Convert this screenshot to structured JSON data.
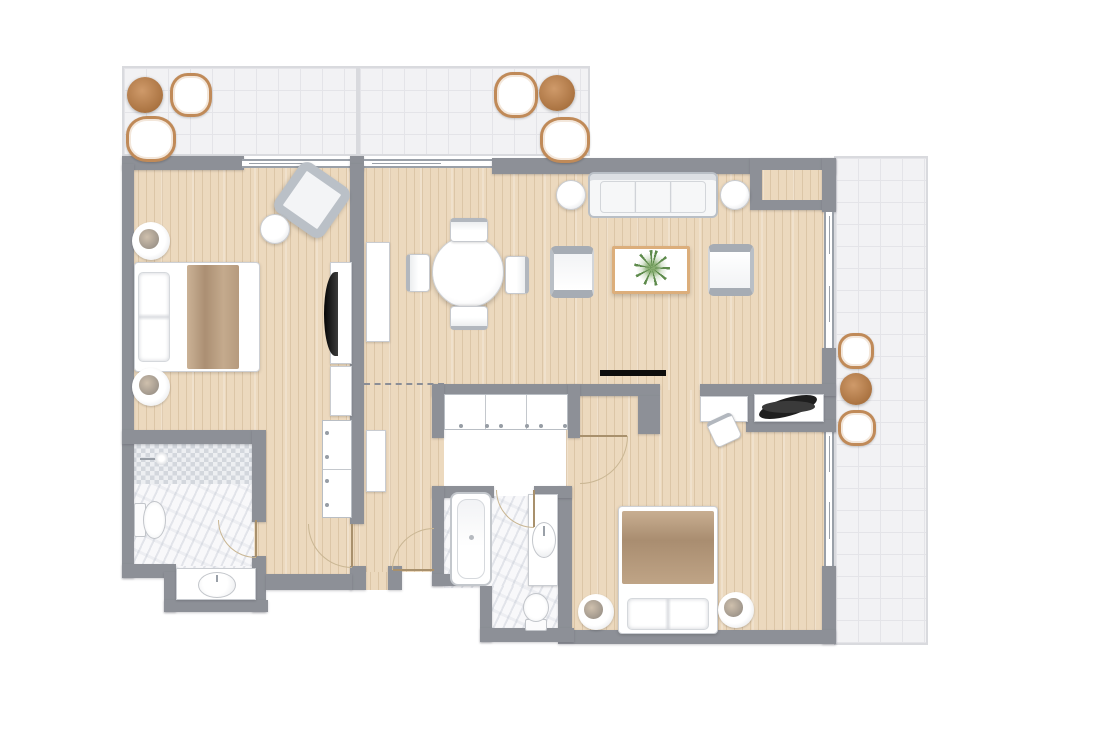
{
  "plan": {
    "kind": "residential-floor-plan",
    "canvas": {
      "width": 1111,
      "height": 739
    },
    "rooms": [
      "balcony-top-left",
      "balcony-top-right",
      "terrace-right",
      "bedroom-1",
      "bathroom-1",
      "hallway",
      "dining-area",
      "living-room",
      "bedroom-2",
      "bathroom-2"
    ]
  },
  "palette": {
    "wall": "#8d9097",
    "wood": "#ecd9be",
    "tile_bg": "#f2f2f4",
    "tile_line": "#e4e4e8",
    "marble": "#f8f8fa",
    "accent_brown": "#b5824f",
    "blanket_tan": "#b69a7e",
    "plant_green": "#5e8b4c",
    "tv_black": "#0c0c0c",
    "door_leaf": "#a8906c",
    "door_arc": "#c9b693"
  },
  "elements": [
    {
      "name": "balcony-top-left",
      "kind": "tile",
      "x": 122,
      "y": 66,
      "w": 236,
      "h": 90
    },
    {
      "name": "balcony-top-right",
      "kind": "tile",
      "x": 358,
      "y": 66,
      "w": 232,
      "h": 90
    },
    {
      "name": "balcony-divider",
      "kind": "balcony-divider",
      "x": 356,
      "y": 66,
      "w": 4,
      "h": 90
    },
    {
      "name": "terrace-right",
      "kind": "tile",
      "x": 834,
      "y": 156,
      "w": 94,
      "h": 489
    },
    {
      "name": "floor-bedroom-1",
      "kind": "wood",
      "x": 130,
      "y": 164,
      "w": 228,
      "h": 410
    },
    {
      "name": "floor-living-dining",
      "kind": "wood",
      "x": 358,
      "y": 168,
      "w": 466,
      "h": 222
    },
    {
      "name": "floor-hallway",
      "kind": "wood",
      "x": 358,
      "y": 390,
      "w": 86,
      "h": 182
    },
    {
      "name": "floor-entry",
      "kind": "wood",
      "x": 362,
      "y": 572,
      "w": 28,
      "h": 18
    },
    {
      "name": "floor-bedroom-2",
      "kind": "wood",
      "x": 566,
      "y": 390,
      "w": 258,
      "h": 244
    },
    {
      "name": "floor-bath-1-main",
      "kind": "marble",
      "x": 130,
      "y": 440,
      "w": 124,
      "h": 128
    },
    {
      "name": "floor-bath-1-alcove",
      "kind": "marble",
      "x": 174,
      "y": 566,
      "w": 82,
      "h": 40
    },
    {
      "name": "shower-mosaic",
      "kind": "mosaic",
      "x": 132,
      "y": 444,
      "w": 122,
      "h": 40
    },
    {
      "name": "floor-bath-2-main",
      "kind": "marble",
      "x": 444,
      "y": 496,
      "w": 114,
      "h": 92
    },
    {
      "name": "floor-bath-2-lower",
      "kind": "marble",
      "x": 492,
      "y": 586,
      "w": 66,
      "h": 44
    },
    {
      "name": "wall-top-bedroom1",
      "kind": "wall",
      "x": 122,
      "y": 156,
      "w": 122,
      "h": 14
    },
    {
      "name": "window-bedroom1-balcony",
      "kind": "window",
      "x": 242,
      "y": 159,
      "w": 110,
      "h": 9
    },
    {
      "name": "wall-top-pillar",
      "kind": "wall",
      "x": 350,
      "y": 156,
      "w": 14,
      "h": 14
    },
    {
      "name": "window-dining-balcony",
      "kind": "window",
      "x": 364,
      "y": 159,
      "w": 128,
      "h": 9
    },
    {
      "name": "wall-top-living",
      "kind": "wall",
      "x": 492,
      "y": 158,
      "w": 344,
      "h": 16
    },
    {
      "name": "wall-niche-topright",
      "kind": "wall",
      "x": 750,
      "y": 158,
      "w": 86,
      "h": 52
    },
    {
      "name": "wood-inset-topright",
      "kind": "wood",
      "x": 762,
      "y": 170,
      "w": 62,
      "h": 30
    },
    {
      "name": "wall-left",
      "kind": "wall",
      "x": 122,
      "y": 164,
      "w": 12,
      "h": 414
    },
    {
      "name": "wall-right-upper",
      "kind": "wall",
      "x": 822,
      "y": 158,
      "w": 14,
      "h": 54
    },
    {
      "name": "window-living-1",
      "kind": "window-v",
      "x": 824,
      "y": 212,
      "w": 10,
      "h": 70
    },
    {
      "name": "window-living-2",
      "kind": "window-v",
      "x": 824,
      "y": 282,
      "w": 10,
      "h": 66
    },
    {
      "name": "wall-right-mid",
      "kind": "wall",
      "x": 822,
      "y": 348,
      "w": 14,
      "h": 84
    },
    {
      "name": "window-bedroom2-1",
      "kind": "window-v",
      "x": 824,
      "y": 432,
      "w": 10,
      "h": 66
    },
    {
      "name": "window-bedroom2-2",
      "kind": "window-v",
      "x": 824,
      "y": 498,
      "w": 10,
      "h": 68
    },
    {
      "name": "wall-right-lower",
      "kind": "wall",
      "x": 822,
      "y": 566,
      "w": 14,
      "h": 78
    },
    {
      "name": "wall-bedroom1-east",
      "kind": "wall",
      "x": 350,
      "y": 164,
      "w": 14,
      "h": 360
    },
    {
      "name": "wall-bedroom1-east-stub",
      "kind": "wall",
      "x": 350,
      "y": 566,
      "w": 16,
      "h": 24
    },
    {
      "name": "wall-bath1-top",
      "kind": "wall",
      "x": 122,
      "y": 430,
      "w": 132,
      "h": 14
    },
    {
      "name": "wall-bath1-east-upper",
      "kind": "wall",
      "x": 252,
      "y": 430,
      "w": 14,
      "h": 92
    },
    {
      "name": "wall-bath1-east-lower",
      "kind": "wall",
      "x": 252,
      "y": 556,
      "w": 14,
      "h": 56
    },
    {
      "name": "wall-bath1-step",
      "kind": "wall",
      "x": 122,
      "y": 564,
      "w": 54,
      "h": 14
    },
    {
      "name": "wall-alcove-west",
      "kind": "wall",
      "x": 164,
      "y": 572,
      "w": 12,
      "h": 40
    },
    {
      "name": "wall-alcove-south",
      "kind": "wall",
      "x": 164,
      "y": 600,
      "w": 104,
      "h": 12
    },
    {
      "name": "wall-hall-south",
      "kind": "wall",
      "x": 266,
      "y": 574,
      "w": 86,
      "h": 16
    },
    {
      "name": "wall-entry-stub",
      "kind": "wall",
      "x": 388,
      "y": 566,
      "w": 14,
      "h": 24
    },
    {
      "name": "wall-closet-north",
      "kind": "wall",
      "x": 432,
      "y": 384,
      "w": 228,
      "h": 12
    },
    {
      "name": "wall-closet-west",
      "kind": "wall",
      "x": 432,
      "y": 384,
      "w": 12,
      "h": 54
    },
    {
      "name": "wall-closet-east",
      "kind": "wall",
      "x": 568,
      "y": 384,
      "w": 12,
      "h": 54
    },
    {
      "name": "wall-bedroom2-entry-east",
      "kind": "wall",
      "x": 638,
      "y": 396,
      "w": 22,
      "h": 38
    },
    {
      "name": "wall-desk-north",
      "kind": "wall",
      "x": 700,
      "y": 384,
      "w": 136,
      "h": 12
    },
    {
      "name": "wall-niche-west",
      "kind": "wall",
      "x": 746,
      "y": 396,
      "w": 10,
      "h": 26
    },
    {
      "name": "wall-niche-south",
      "kind": "wall",
      "x": 746,
      "y": 420,
      "w": 90,
      "h": 12
    },
    {
      "name": "wall-bedroom2-west",
      "kind": "wall",
      "x": 558,
      "y": 486,
      "w": 14,
      "h": 148
    },
    {
      "name": "wall-bedroom2-south",
      "kind": "wall",
      "x": 558,
      "y": 630,
      "w": 278,
      "h": 14
    },
    {
      "name": "wall-bath2-north-a",
      "kind": "wall",
      "x": 432,
      "y": 486,
      "w": 62,
      "h": 12
    },
    {
      "name": "wall-bath2-north-b",
      "kind": "wall",
      "x": 534,
      "y": 486,
      "w": 38,
      "h": 12
    },
    {
      "name": "wall-bath2-west",
      "kind": "wall",
      "x": 432,
      "y": 486,
      "w": 12,
      "h": 100
    },
    {
      "name": "wall-bath2-step",
      "kind": "wall",
      "x": 432,
      "y": 574,
      "w": 52,
      "h": 12
    },
    {
      "name": "wall-bath2-west-lower",
      "kind": "wall",
      "x": 480,
      "y": 586,
      "w": 12,
      "h": 56
    },
    {
      "name": "wall-bath2-south",
      "kind": "wall",
      "x": 480,
      "y": 628,
      "w": 94,
      "h": 14
    },
    {
      "name": "plant-niche-back",
      "kind": "niche-white",
      "x": 754,
      "y": 394,
      "w": 70,
      "h": 28
    },
    {
      "name": "bed-bedroom1",
      "kind": "bed bed-left",
      "x": 134,
      "y": 262,
      "w": 126,
      "h": 110
    },
    {
      "name": "nightstand-lamp-1",
      "kind": "lamp",
      "x": 132,
      "y": 222,
      "w": 38,
      "h": 38
    },
    {
      "name": "nightstand-lamp-2",
      "kind": "lamp",
      "x": 132,
      "y": 368,
      "w": 38,
      "h": 38
    },
    {
      "name": "armchair-bedroom1",
      "kind": "armchair-diag",
      "x": 282,
      "y": 170,
      "w": 60,
      "h": 60,
      "rot": 35
    },
    {
      "name": "side-table-bedroom1",
      "kind": "side-table",
      "x": 260,
      "y": 214,
      "w": 30,
      "h": 30
    },
    {
      "name": "tv-console-bedroom1",
      "kind": "console",
      "x": 330,
      "y": 262,
      "w": 22,
      "h": 102
    },
    {
      "name": "tv-bedroom1",
      "kind": "tv-v",
      "x": 324,
      "y": 272,
      "w": 14,
      "h": 84
    },
    {
      "name": "cabinet-bedroom1",
      "kind": "cabinet",
      "x": 330,
      "y": 366,
      "w": 22,
      "h": 50
    },
    {
      "name": "wardrobe-bedroom1",
      "kind": "wardrobe",
      "x": 322,
      "y": 420,
      "w": 30,
      "h": 98
    },
    {
      "name": "cabinet-hall-tall",
      "kind": "cabinet",
      "x": 366,
      "y": 242,
      "w": 24,
      "h": 100
    },
    {
      "name": "cabinet-hall-small",
      "kind": "cabinet",
      "x": 366,
      "y": 430,
      "w": 20,
      "h": 62
    },
    {
      "name": "closet-sliding-doors",
      "kind": "closet-sliding",
      "x": 444,
      "y": 394,
      "w": 124,
      "h": 36
    },
    {
      "name": "dining-table",
      "kind": "dining-table",
      "x": 432,
      "y": 236,
      "w": 72,
      "h": 72
    },
    {
      "name": "dining-chair-north",
      "kind": "chair",
      "x": 450,
      "y": 218,
      "w": 38,
      "h": 24,
      "rot": 0
    },
    {
      "name": "dining-chair-south",
      "kind": "chair",
      "x": 450,
      "y": 306,
      "w": 38,
      "h": 24,
      "rot": 180
    },
    {
      "name": "dining-chair-west",
      "kind": "chair",
      "x": 399,
      "y": 261,
      "w": 38,
      "h": 24,
      "rot": -90
    },
    {
      "name": "dining-chair-east",
      "kind": "chair",
      "x": 498,
      "y": 263,
      "w": 38,
      "h": 24,
      "rot": 90
    },
    {
      "name": "sofa-living",
      "kind": "sofa",
      "x": 588,
      "y": 172,
      "w": 130,
      "h": 46
    },
    {
      "name": "side-table-sofa-left",
      "kind": "side-table",
      "x": 556,
      "y": 180,
      "w": 30,
      "h": 30
    },
    {
      "name": "side-table-sofa-right",
      "kind": "side-table",
      "x": 720,
      "y": 180,
      "w": 30,
      "h": 30
    },
    {
      "name": "coffee-table",
      "kind": "coffee-table",
      "x": 612,
      "y": 246,
      "w": 78,
      "h": 48
    },
    {
      "name": "plant-coffee-table",
      "kind": "plant-green",
      "x": 634,
      "y": 250,
      "w": 36,
      "h": 36
    },
    {
      "name": "armchair-living-left",
      "kind": "armchair",
      "x": 550,
      "y": 246,
      "w": 44,
      "h": 52,
      "rot": 0
    },
    {
      "name": "armchair-living-right",
      "kind": "armchair",
      "x": 708,
      "y": 244,
      "w": 46,
      "h": 52,
      "rot": 180
    },
    {
      "name": "tv-wall-living",
      "kind": "tv-line",
      "x": 600,
      "y": 370,
      "w": 66,
      "h": 6
    },
    {
      "name": "ceiling-divider-dashed",
      "kind": "dashed",
      "x": 364,
      "y": 383,
      "w": 80,
      "h": 2
    },
    {
      "name": "desk-bedroom2",
      "kind": "desk",
      "x": 700,
      "y": 396,
      "w": 48,
      "h": 26
    },
    {
      "name": "desk-chair-bedroom2",
      "kind": "desk-chair",
      "x": 710,
      "y": 416,
      "w": 28,
      "h": 28,
      "rot": -25
    },
    {
      "name": "plant-niche-decor",
      "kind": "plant-dark",
      "x": 758,
      "y": 398,
      "w": 60,
      "h": 18,
      "rot": -10
    },
    {
      "name": "bed-bedroom2",
      "kind": "bed bed-bottom",
      "x": 618,
      "y": 506,
      "w": 100,
      "h": 128
    },
    {
      "name": "nightstand-lamp-3",
      "kind": "lamp",
      "x": 578,
      "y": 594,
      "w": 36,
      "h": 36
    },
    {
      "name": "nightstand-lamp-4",
      "kind": "lamp",
      "x": 718,
      "y": 592,
      "w": 36,
      "h": 36
    },
    {
      "name": "bathtub",
      "kind": "bathtub",
      "x": 450,
      "y": 492,
      "w": 42,
      "h": 94
    },
    {
      "name": "vanity-bath2",
      "kind": "vanity",
      "x": 528,
      "y": 494,
      "w": 30,
      "h": 92
    },
    {
      "name": "sink-bath2",
      "kind": "sink-oval",
      "x": 532,
      "y": 522,
      "w": 24,
      "h": 36
    },
    {
      "name": "toilet-bath2",
      "kind": "toilet",
      "x": 516,
      "y": 596,
      "w": 40,
      "h": 30,
      "rot": -90
    },
    {
      "name": "shower-head",
      "kind": "shower-head",
      "x": 140,
      "y": 452,
      "w": 28,
      "h": 16
    },
    {
      "name": "toilet-bath1",
      "kind": "toilet",
      "x": 134,
      "y": 498,
      "w": 34,
      "h": 44
    },
    {
      "name": "vanity-bath1",
      "kind": "vanity",
      "x": 176,
      "y": 568,
      "w": 80,
      "h": 32
    },
    {
      "name": "sink-bath1",
      "kind": "sink-oval",
      "x": 198,
      "y": 572,
      "w": 38,
      "h": 26
    },
    {
      "name": "patio-table-1",
      "kind": "table-brown",
      "x": 127,
      "y": 77,
      "w": 36,
      "h": 36
    },
    {
      "name": "patio-chair-1",
      "kind": "patio-chair",
      "x": 170,
      "y": 73,
      "w": 42,
      "h": 44
    },
    {
      "name": "patio-chair-2",
      "kind": "patio-chair",
      "x": 126,
      "y": 116,
      "w": 50,
      "h": 46
    },
    {
      "name": "patio-chair-3",
      "kind": "patio-chair",
      "x": 494,
      "y": 72,
      "w": 44,
      "h": 46
    },
    {
      "name": "patio-table-2",
      "kind": "table-brown",
      "x": 539,
      "y": 75,
      "w": 36,
      "h": 36
    },
    {
      "name": "patio-chair-4",
      "kind": "patio-chair",
      "x": 540,
      "y": 117,
      "w": 50,
      "h": 46
    },
    {
      "name": "patio-chair-5",
      "kind": "patio-chair",
      "x": 838,
      "y": 333,
      "w": 36,
      "h": 36
    },
    {
      "name": "patio-table-3",
      "kind": "table-brown",
      "x": 840,
      "y": 373,
      "w": 32,
      "h": 32
    },
    {
      "name": "patio-chair-6",
      "kind": "patio-chair",
      "x": 838,
      "y": 410,
      "w": 38,
      "h": 36
    },
    {
      "name": "door-bath1",
      "kind": "door",
      "x": 218,
      "y": 520,
      "w": 38,
      "h": 38,
      "rot": 90
    },
    {
      "name": "door-bedroom1-hall",
      "kind": "door",
      "x": 308,
      "y": 524,
      "w": 44,
      "h": 44,
      "rot": 90
    },
    {
      "name": "door-entry",
      "kind": "door",
      "x": 392,
      "y": 528,
      "w": 42,
      "h": 42,
      "rot": 180
    },
    {
      "name": "door-bedroom2",
      "kind": "door",
      "x": 580,
      "y": 436,
      "w": 48,
      "h": 48,
      "rot": 0
    },
    {
      "name": "door-bath2",
      "kind": "door",
      "x": 496,
      "y": 490,
      "w": 38,
      "h": 38,
      "rot": 90
    }
  ]
}
